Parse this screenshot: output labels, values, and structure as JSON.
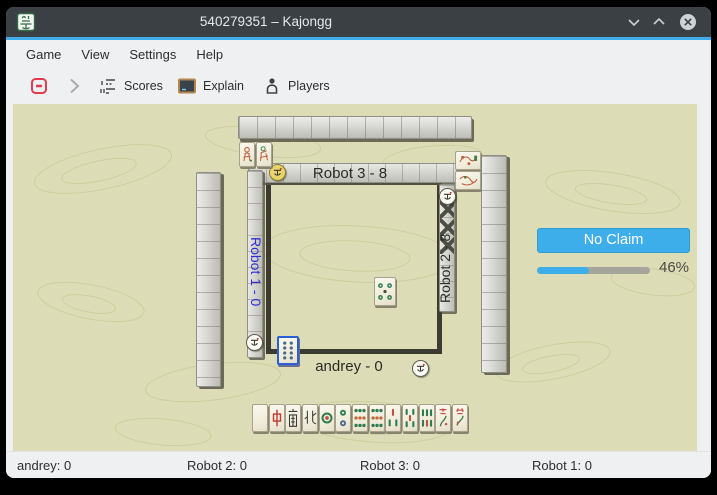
{
  "window": {
    "title": "540279351 – Kajongg",
    "controls": {
      "minimize": "chevron-down",
      "maximize": "chevron-up",
      "close": "circle-x"
    }
  },
  "menubar": {
    "items": [
      "Game",
      "View",
      "Settings",
      "Help"
    ]
  },
  "toolbar": {
    "abort_icon": "abort-game-icon",
    "next_icon": "chevron-right-icon",
    "scores_label": "Scores",
    "explain_label": "Explain",
    "players_label": "Players"
  },
  "board": {
    "background_color": "#dcddb6",
    "accent_color": "#3daee9",
    "players": {
      "top": {
        "label": "Robot 3 - 8"
      },
      "left": {
        "label": "Robot 1 - 0",
        "name_color": "#2f2fd2"
      },
      "right": {
        "label": "Robot 2 - 8"
      },
      "bottom": {
        "label": "andrey - 0"
      }
    },
    "claim_button": "No Claim",
    "progress": {
      "percent": 46,
      "label": "46%"
    },
    "hand_tiles": [
      "White Dragon",
      "Red Dragon",
      "South Wind",
      "North Wind",
      "Circle 1",
      "Circle 2",
      "Circle 9",
      "Circle 9",
      "Bamboo 3",
      "Bamboo 5",
      "Bamboo 6",
      "Season",
      "Season"
    ],
    "center_discard": "Circle 5",
    "focused_tile": "Circle 8",
    "bonus_tiles_top": [
      "Season",
      "Season"
    ],
    "bonus_tiles_right": [
      "Flower",
      "Flower"
    ]
  },
  "statusbar": {
    "items": [
      "andrey: 0",
      "Robot 2: 0",
      "Robot 3: 0",
      "Robot 1: 0"
    ]
  }
}
